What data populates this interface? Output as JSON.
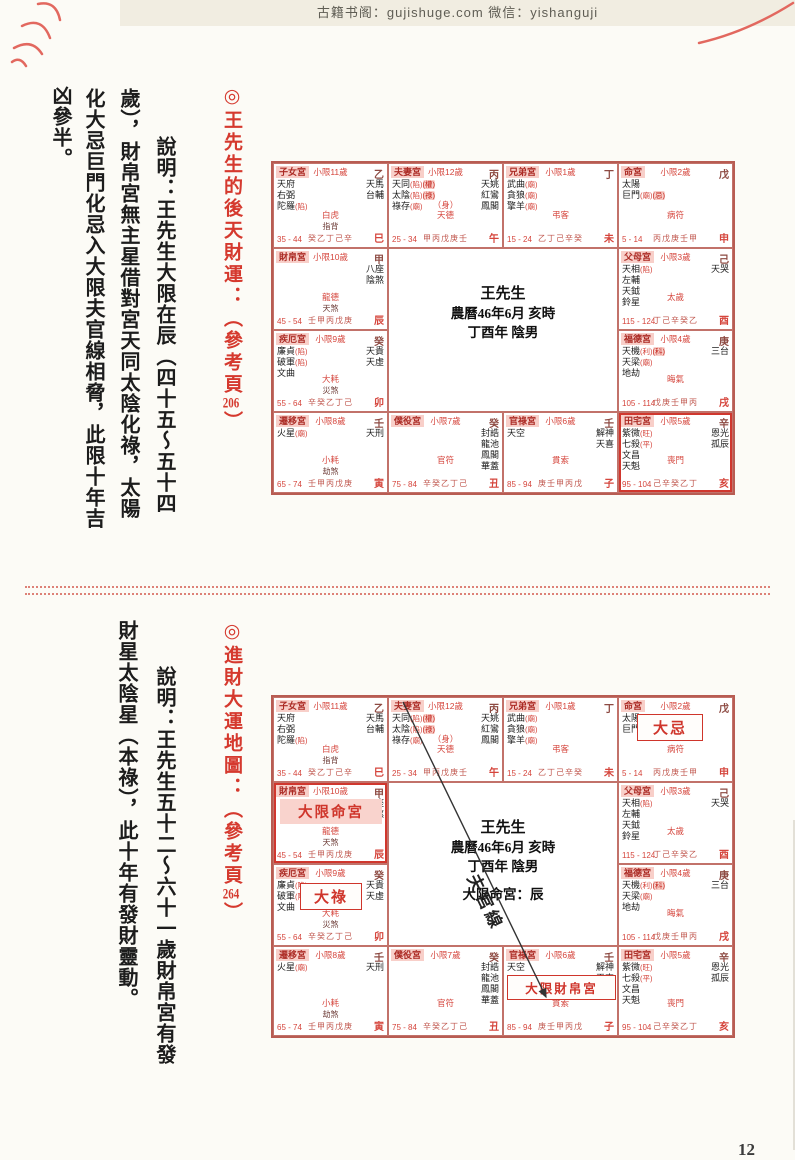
{
  "page": {
    "header_text": "古籍书阁：gujishuge.com 微信：yishanguji",
    "page_number": "12",
    "accent_red": "#d5392e",
    "pink_bg": "#f8cfc9"
  },
  "section1": {
    "title_prefix": "◎王先生的後天財運：（參考頁",
    "title_num": "206",
    "title_suffix": "）",
    "cols": [
      "說明：王先生大限在辰（四十五～五十四",
      "歲），財帛宮無主星借對宮天同太陰化祿，太陽",
      "化大忌巨門化忌入大限夫官線相脅，此限十年吉",
      "凶參半。"
    ]
  },
  "section2": {
    "title_prefix": "◎進財大運地圖：（參考頁",
    "title_num": "264",
    "title_suffix": "）",
    "cols": [
      "說明：王先生五十二～六十一歲財帛宮有發",
      "財星太陰星（本祿），此十年有發財靈動。"
    ]
  },
  "chart_center": {
    "name": "王先生",
    "line2": "農曆46年6月 亥時",
    "line3": "丁酉年 陰男",
    "daxian_line": "大限命宮：辰"
  },
  "overlays": {
    "daxian_mingong": "大限命宮",
    "dalu": "大祿",
    "daji": "大忌",
    "daxian_caibo": "大限財帛宮",
    "fuguan_label": "夫官線"
  },
  "palaces": [
    {
      "id": "si",
      "pos": [
        0,
        0
      ],
      "name": "子女宮",
      "xiaoxian": "小限11歲",
      "stem": "乙",
      "left": [
        "天府",
        "右弼",
        "陀羅(陷)"
      ],
      "right": [
        "天馬",
        "台輔"
      ],
      "mid": "白虎",
      "mid_sub": "指背",
      "range": "35 - 44",
      "stems": "癸乙丁己辛",
      "branch": "巳"
    },
    {
      "id": "wu",
      "pos": [
        1,
        0
      ],
      "name": "夫妻宮",
      "xiaoxian": "小限12歲",
      "stem": "丙",
      "left": [
        "天同(陷)[權]",
        "太陰(陷)[祿]",
        "祿存(廟)"
      ],
      "right": [
        "天姚",
        "紅鸞",
        "鳳閣"
      ],
      "mid_pre": "（身）",
      "mid": "天德",
      "range": "25 - 34",
      "stems": "甲丙戊庚壬",
      "branch": "午"
    },
    {
      "id": "wei",
      "pos": [
        2,
        0
      ],
      "name": "兄弟宮",
      "xiaoxian": "小限1歲",
      "stem": "丁",
      "left": [
        "武曲(廟)",
        "貪狼(廟)",
        "擎羊(廟)"
      ],
      "right": [],
      "mid": "弔客",
      "range": "15 - 24",
      "stems": "乙丁己辛癸",
      "branch": "未"
    },
    {
      "id": "shen",
      "pos": [
        3,
        0
      ],
      "name": "命宮",
      "xiaoxian": "小限2歲",
      "stem": "戊",
      "left": [
        "太陽",
        "巨門(廟)[忌]"
      ],
      "right": [],
      "mid": "病符",
      "range": "5 - 14",
      "stems": "丙戊庚壬甲",
      "branch": "申"
    },
    {
      "id": "chen",
      "pos": [
        0,
        1
      ],
      "name": "財帛宮",
      "xiaoxian": "小限10歲",
      "stem": "甲",
      "left": [],
      "right": [
        "八座",
        "陰煞"
      ],
      "mid": "龍德",
      "mid_sub": "天煞",
      "range": "45 - 54",
      "stems": "壬甲丙戊庚",
      "branch": "辰"
    },
    {
      "id": "you",
      "pos": [
        3,
        1
      ],
      "name": "父母宮",
      "xiaoxian": "小限3歲",
      "stem": "己",
      "left": [
        "天相(陷)",
        "左輔",
        "天鉞",
        "鈴星"
      ],
      "right": [
        "天哭"
      ],
      "mid": "太歲",
      "range": "115 - 124",
      "stems": "丁己辛癸乙",
      "branch": "酉"
    },
    {
      "id": "mao",
      "pos": [
        0,
        2
      ],
      "name": "疾厄宮",
      "xiaoxian": "小限9歲",
      "stem": "癸",
      "left": [
        "廉貞(陷)",
        "破軍(陷)",
        "文曲"
      ],
      "right": [
        "天貴",
        "天虛"
      ],
      "mid": "大耗",
      "mid_sub": "災煞",
      "range": "55 - 64",
      "stems": "辛癸乙丁己",
      "branch": "卯"
    },
    {
      "id": "xu",
      "pos": [
        3,
        2
      ],
      "name": "福德宮",
      "xiaoxian": "小限4歲",
      "stem": "庚",
      "left": [
        "天機(利)[科]",
        "天梁(廟)",
        "地劫"
      ],
      "right": [
        "三台"
      ],
      "mid": "晦氣",
      "range": "105 - 114",
      "stems": "戊庚壬甲丙",
      "branch": "戌"
    },
    {
      "id": "yin",
      "pos": [
        0,
        3
      ],
      "name": "遷移宮",
      "xiaoxian": "小限8歲",
      "stem": "壬",
      "left": [
        "火星(廟)"
      ],
      "right": [
        "天刑"
      ],
      "mid": "小耗",
      "mid_sub": "劫煞",
      "range": "65 - 74",
      "stems": "壬甲丙戊庚",
      "branch": "寅"
    },
    {
      "id": "chou",
      "pos": [
        1,
        3
      ],
      "name": "僕役宮",
      "xiaoxian": "小限7歲",
      "stem": "癸",
      "left": [],
      "right": [
        "封誥",
        "龍池",
        "鳳閣",
        "華蓋"
      ],
      "mid": "官符",
      "range": "75 - 84",
      "stems": "辛癸乙丁己",
      "branch": "丑"
    },
    {
      "id": "zi",
      "pos": [
        2,
        3
      ],
      "name": "官祿宮",
      "xiaoxian": "小限6歲",
      "stem": "壬",
      "left": [
        "天空"
      ],
      "right": [
        "解神",
        "天喜"
      ],
      "mid": "貫索",
      "range": "85 - 94",
      "stems": "庚壬甲丙戊",
      "branch": "子"
    },
    {
      "id": "hai",
      "pos": [
        3,
        3
      ],
      "name": "田宅宮",
      "xiaoxian": "小限5歲",
      "stem": "辛",
      "left": [
        "紫微(旺)",
        "七殺(平)",
        "文昌",
        "天魁"
      ],
      "right": [
        "恩光",
        "孤辰"
      ],
      "mid": "喪門",
      "range": "95 - 104",
      "stems": "己辛癸乙丁",
      "branch": "亥"
    }
  ]
}
